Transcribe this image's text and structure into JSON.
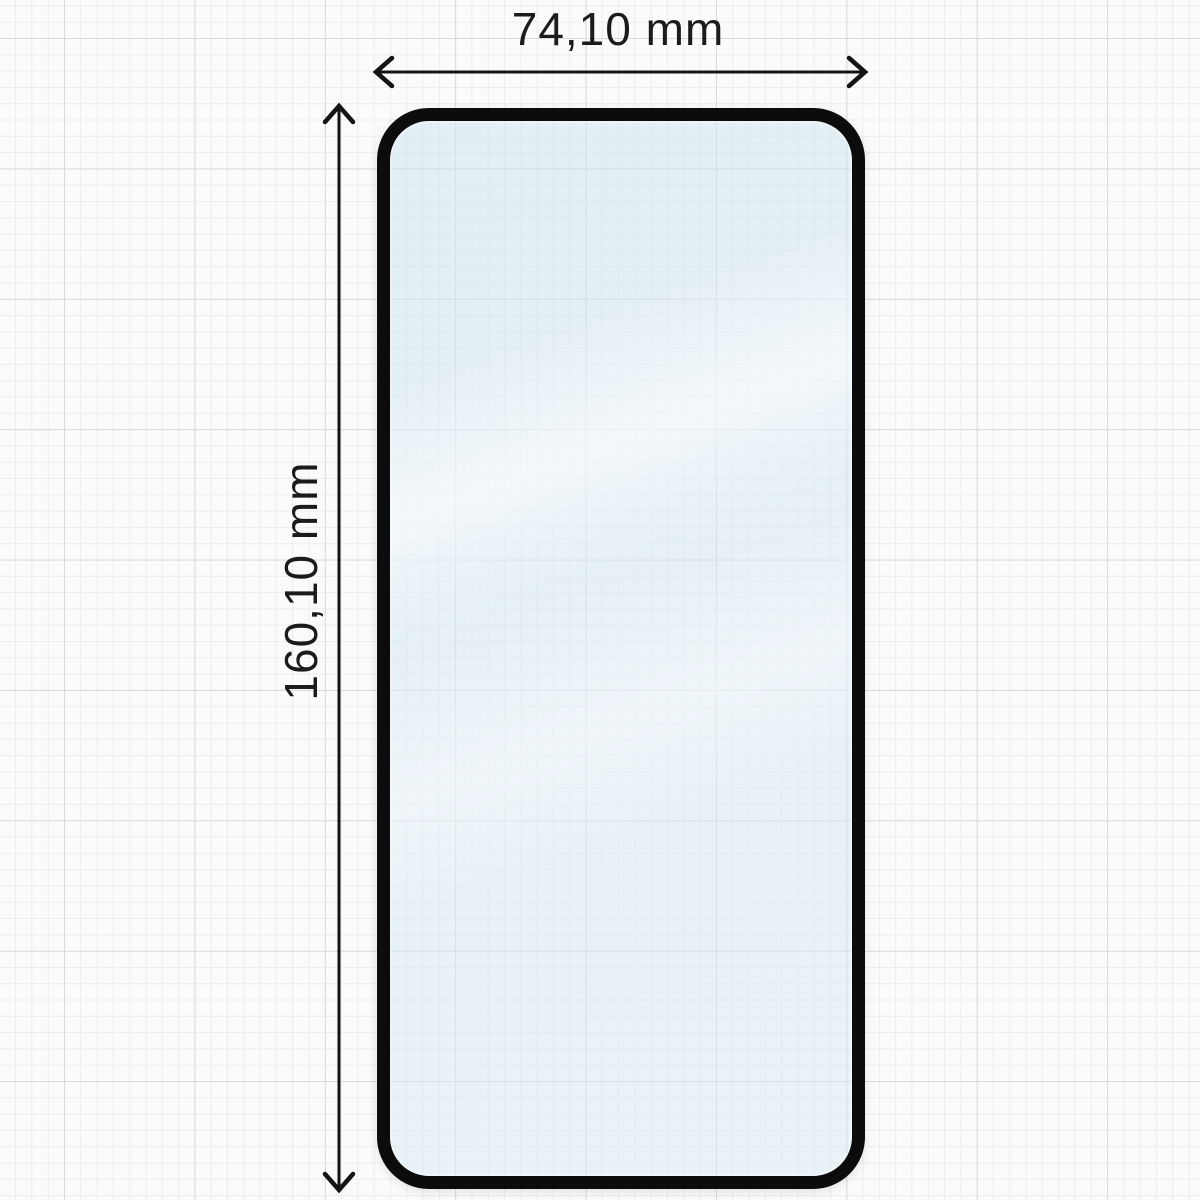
{
  "dimensions": {
    "width": {
      "label": "74,10 mm",
      "orientation": "horizontal"
    },
    "height": {
      "label": "160,10 mm",
      "orientation": "vertical"
    }
  },
  "protector": {
    "kind": "tempered-glass-screen-protector",
    "frame_color": "#0c0c0c",
    "glass_tint": "#e8f2f7"
  },
  "annotation": {
    "line_color": "#141414",
    "text_color": "#1b1b1b"
  },
  "background": {
    "type": "graph-paper",
    "paper_color": "#fbfbfb",
    "minor_line_color": "#ededed",
    "major_line_color": "#d9d9d9"
  }
}
